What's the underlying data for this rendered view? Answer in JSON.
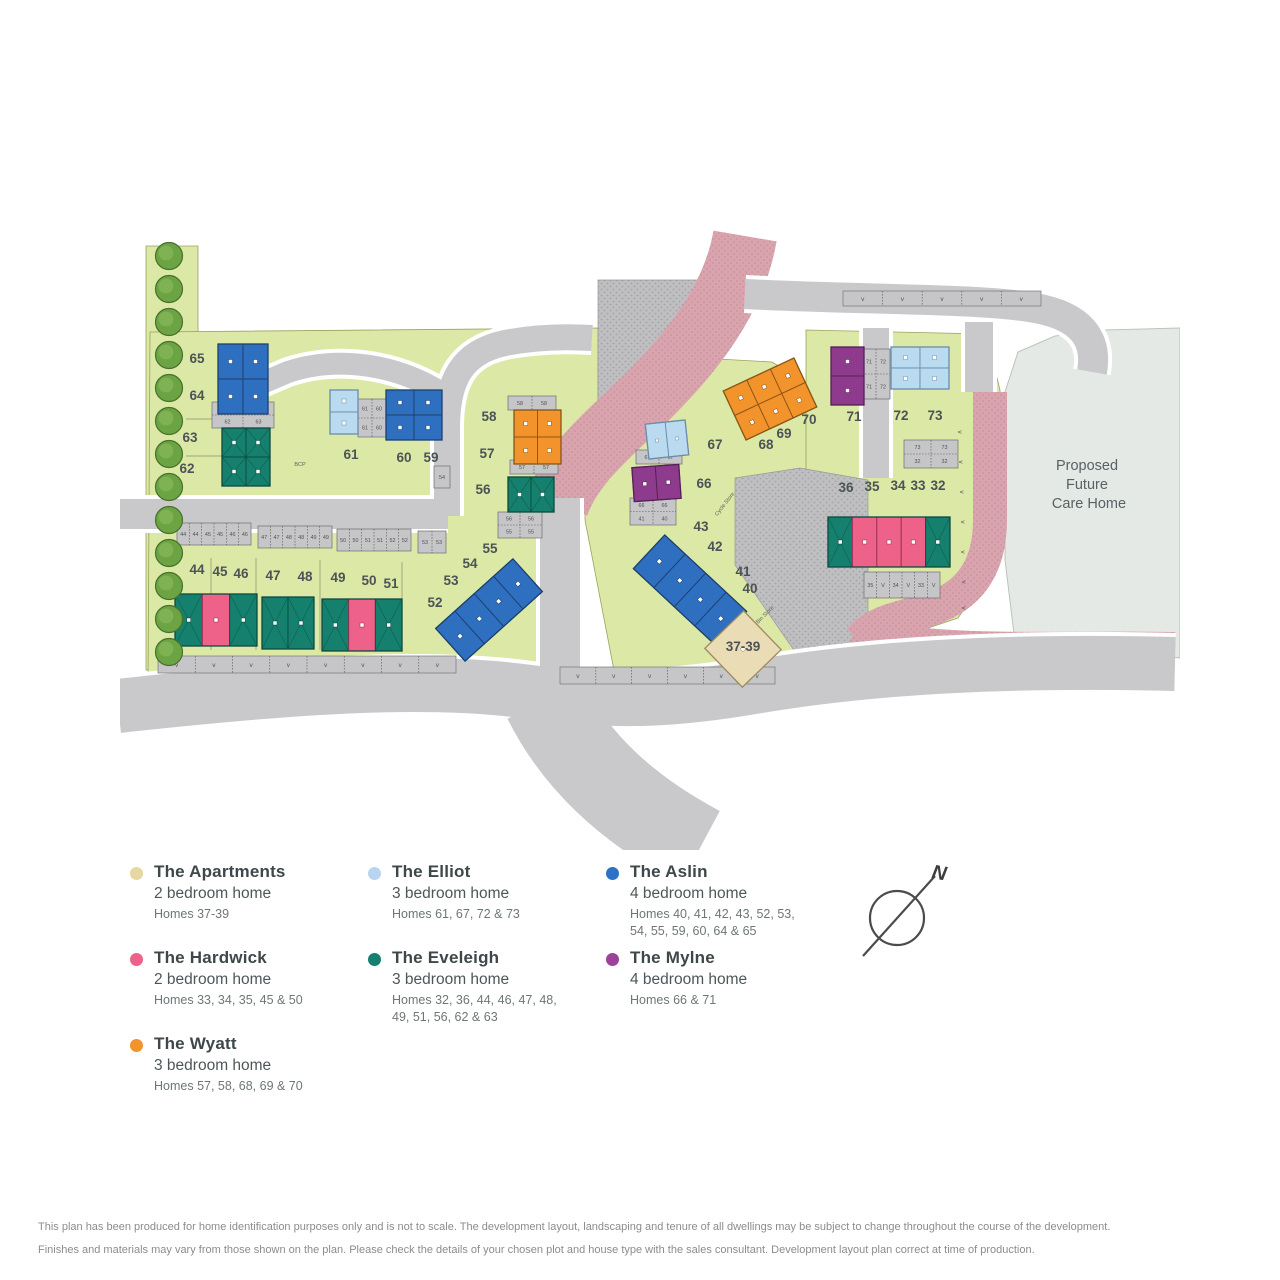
{
  "map": {
    "care_home_label_lines": [
      "Proposed",
      "Future",
      "Care Home"
    ],
    "small_labels": {
      "bcp": "BCP",
      "bin_store": "Bin Store",
      "cycle_store": "Cycle Store",
      "visitor": "v"
    },
    "plot_labels": [
      {
        "t": "65",
        "x": 197,
        "y": 363
      },
      {
        "t": "64",
        "x": 197,
        "y": 400
      },
      {
        "t": "63",
        "x": 190,
        "y": 442
      },
      {
        "t": "62",
        "x": 187,
        "y": 473
      },
      {
        "t": "61",
        "x": 351,
        "y": 459
      },
      {
        "t": "60",
        "x": 404,
        "y": 462
      },
      {
        "t": "59",
        "x": 431,
        "y": 462
      },
      {
        "t": "58",
        "x": 489,
        "y": 421
      },
      {
        "t": "57",
        "x": 487,
        "y": 458
      },
      {
        "t": "56",
        "x": 483,
        "y": 494
      },
      {
        "t": "55",
        "x": 490,
        "y": 553
      },
      {
        "t": "54",
        "x": 470,
        "y": 568
      },
      {
        "t": "53",
        "x": 451,
        "y": 585
      },
      {
        "t": "52",
        "x": 435,
        "y": 607
      },
      {
        "t": "44",
        "x": 197,
        "y": 574
      },
      {
        "t": "45",
        "x": 220,
        "y": 576
      },
      {
        "t": "46",
        "x": 241,
        "y": 578
      },
      {
        "t": "47",
        "x": 273,
        "y": 580
      },
      {
        "t": "48",
        "x": 305,
        "y": 581
      },
      {
        "t": "49",
        "x": 338,
        "y": 582
      },
      {
        "t": "50",
        "x": 369,
        "y": 585
      },
      {
        "t": "51",
        "x": 391,
        "y": 588
      },
      {
        "t": "43",
        "x": 701,
        "y": 531
      },
      {
        "t": "42",
        "x": 715,
        "y": 551
      },
      {
        "t": "41",
        "x": 743,
        "y": 576
      },
      {
        "t": "40",
        "x": 750,
        "y": 593
      },
      {
        "t": "37-39",
        "x": 743,
        "y": 651
      },
      {
        "t": "67",
        "x": 715,
        "y": 449
      },
      {
        "t": "66",
        "x": 704,
        "y": 488
      },
      {
        "t": "68",
        "x": 766,
        "y": 449
      },
      {
        "t": "69",
        "x": 784,
        "y": 438
      },
      {
        "t": "70",
        "x": 809,
        "y": 424
      },
      {
        "t": "71",
        "x": 854,
        "y": 421
      },
      {
        "t": "72",
        "x": 901,
        "y": 420
      },
      {
        "t": "73",
        "x": 935,
        "y": 420
      },
      {
        "t": "36",
        "x": 846,
        "y": 492
      },
      {
        "t": "35",
        "x": 872,
        "y": 491
      },
      {
        "t": "34",
        "x": 898,
        "y": 490
      },
      {
        "t": "33",
        "x": 918,
        "y": 490
      },
      {
        "t": "32",
        "x": 938,
        "y": 490
      }
    ],
    "buildings": [
      {
        "x": 218,
        "y": 344,
        "w": 50,
        "h": 70,
        "rot": 0,
        "rows": 2,
        "cols": 2,
        "c": "aslin"
      },
      {
        "x": 222,
        "y": 428,
        "w": 48,
        "h": 58,
        "rot": 0,
        "rows": 2,
        "cols": 2,
        "c": "eveleigh"
      },
      {
        "x": 330,
        "y": 390,
        "w": 28,
        "h": 44,
        "rot": 0,
        "rows": 2,
        "cols": 1,
        "c": "elliot"
      },
      {
        "x": 386,
        "y": 390,
        "w": 56,
        "h": 50,
        "rot": 0,
        "rows": 2,
        "cols": 2,
        "c": "aslin"
      },
      {
        "x": 514,
        "y": 410,
        "w": 47,
        "h": 54,
        "rot": 0,
        "rows": 2,
        "cols": 2,
        "c": "wyatt"
      },
      {
        "x": 508,
        "y": 477,
        "w": 46,
        "h": 35,
        "rot": 0,
        "rows": 1,
        "cols": 2,
        "c": "eveleigh"
      },
      {
        "x": 437,
        "y": 588,
        "w": 104,
        "h": 44,
        "rot": -42,
        "rows": 1,
        "cols": 4,
        "c": "aslin"
      },
      {
        "x": 175,
        "y": 594,
        "w": 82,
        "h": 52,
        "rot": 0,
        "rows": 1,
        "cols": 3,
        "u": [
          "eveleigh",
          "hardwick",
          "eveleigh"
        ]
      },
      {
        "x": 262,
        "y": 597,
        "w": 52,
        "h": 52,
        "rot": 0,
        "rows": 1,
        "cols": 2,
        "c": "eveleigh"
      },
      {
        "x": 322,
        "y": 599,
        "w": 80,
        "h": 52,
        "rot": 0,
        "rows": 1,
        "cols": 3,
        "u": [
          "eveleigh",
          "hardwick",
          "eveleigh"
        ]
      },
      {
        "x": 634,
        "y": 567,
        "w": 112,
        "h": 46,
        "rot": 43,
        "rows": 1,
        "cols": 4,
        "c": "aslin"
      },
      {
        "x": 716,
        "y": 622,
        "w": 54,
        "h": 54,
        "rot": -44,
        "rows": 1,
        "cols": 1,
        "c": "apartments"
      },
      {
        "x": 647,
        "y": 422,
        "w": 40,
        "h": 35,
        "rot": -6,
        "rows": 1,
        "cols": 2,
        "c": "elliot"
      },
      {
        "x": 633,
        "y": 466,
        "w": 47,
        "h": 34,
        "rot": -4,
        "rows": 1,
        "cols": 2,
        "c": "mylne"
      },
      {
        "x": 731,
        "y": 372,
        "w": 78,
        "h": 54,
        "rot": -25,
        "rows": 2,
        "cols": 3,
        "c": "wyatt"
      },
      {
        "x": 831,
        "y": 347,
        "w": 33,
        "h": 58,
        "rot": 0,
        "rows": 2,
        "cols": 1,
        "c": "mylne"
      },
      {
        "x": 891,
        "y": 347,
        "w": 58,
        "h": 42,
        "rot": 0,
        "rows": 2,
        "cols": 2,
        "c": "elliot"
      },
      {
        "x": 828,
        "y": 517,
        "w": 122,
        "h": 50,
        "rot": 0,
        "rows": 1,
        "cols": 5,
        "u": [
          "eveleigh",
          "hardwick",
          "hardwick",
          "hardwick",
          "eveleigh"
        ]
      }
    ],
    "parking_chips": [
      {
        "x": 177,
        "y": 523,
        "w": 74,
        "h": 22,
        "rows": 1,
        "cols": 6,
        "nums": [
          "44",
          "44",
          "45",
          "45",
          "46",
          "46"
        ]
      },
      {
        "x": 258,
        "y": 526,
        "w": 74,
        "h": 22,
        "rows": 1,
        "cols": 6,
        "nums": [
          "47",
          "47",
          "48",
          "48",
          "49",
          "49"
        ]
      },
      {
        "x": 337,
        "y": 529,
        "w": 74,
        "h": 22,
        "rows": 1,
        "cols": 6,
        "nums": [
          "50",
          "50",
          "51",
          "51",
          "52",
          "52"
        ]
      },
      {
        "x": 418,
        "y": 531,
        "w": 28,
        "h": 22,
        "rows": 1,
        "cols": 2,
        "nums": [
          "53",
          "53"
        ]
      },
      {
        "x": 212,
        "y": 402,
        "w": 62,
        "h": 26,
        "rows": 2,
        "cols": 2,
        "nums": [
          "64",
          "64",
          "62",
          "63"
        ]
      },
      {
        "x": 358,
        "y": 399,
        "w": 28,
        "h": 38,
        "rows": 2,
        "cols": 2,
        "nums": [
          "61",
          "60",
          "61",
          "60"
        ]
      },
      {
        "x": 508,
        "y": 396,
        "w": 48,
        "h": 14,
        "rows": 1,
        "cols": 2,
        "nums": [
          "58",
          "58"
        ]
      },
      {
        "x": 510,
        "y": 460,
        "w": 48,
        "h": 14,
        "rows": 1,
        "cols": 2,
        "nums": [
          "57",
          "57"
        ]
      },
      {
        "x": 498,
        "y": 512,
        "w": 44,
        "h": 26,
        "rows": 2,
        "cols": 2,
        "nums": [
          "56",
          "56",
          "55",
          "55"
        ]
      },
      {
        "x": 434,
        "y": 466,
        "w": 16,
        "h": 22,
        "rows": 1,
        "cols": 1,
        "nums": [
          "54"
        ]
      },
      {
        "x": 636,
        "y": 450,
        "w": 46,
        "h": 14,
        "rows": 1,
        "cols": 2,
        "nums": [
          "67",
          "67"
        ]
      },
      {
        "x": 630,
        "y": 498,
        "w": 46,
        "h": 27,
        "rows": 2,
        "cols": 2,
        "nums": [
          "66",
          "66",
          "41",
          "40"
        ]
      },
      {
        "x": 862,
        "y": 349,
        "w": 28,
        "h": 50,
        "rows": 2,
        "cols": 2,
        "nums": [
          "71",
          "72",
          "71",
          "72"
        ]
      },
      {
        "x": 904,
        "y": 440,
        "w": 54,
        "h": 28,
        "rows": 2,
        "cols": 2,
        "nums": [
          "73",
          "73",
          "32",
          "32"
        ]
      },
      {
        "x": 864,
        "y": 572,
        "w": 76,
        "h": 26,
        "rows": 1,
        "cols": 6,
        "nums": [
          "35",
          "V",
          "34",
          "V",
          "33",
          "V"
        ]
      }
    ],
    "visitor_strips": [
      {
        "x": 158,
        "y": 656,
        "w": 298,
        "h": 17,
        "count": 8
      },
      {
        "x": 560,
        "y": 667,
        "w": 215,
        "h": 17,
        "count": 6
      },
      {
        "x": 843,
        "y": 291,
        "w": 198,
        "h": 15,
        "count": 5
      }
    ],
    "visitor_marks": [
      [
        958,
        432
      ],
      [
        959,
        462
      ],
      [
        960,
        492
      ],
      [
        961,
        522
      ],
      [
        961,
        552
      ],
      [
        962,
        582
      ],
      [
        962,
        608
      ]
    ],
    "trees": {
      "x": 169,
      "y_start": 256,
      "step": 33,
      "count": 13,
      "r": 13.5
    }
  },
  "legend": {
    "items": [
      {
        "name": "The Apartments",
        "type": "2 bedroom home",
        "homes": "Homes 37-39",
        "color": "#e7d7a3"
      },
      {
        "name": "The Elliot",
        "type": "3 bedroom home",
        "homes": "Homes 61, 67, 72 & 73",
        "color": "#b9d4ef"
      },
      {
        "name": "The Aslin",
        "type": "4 bedroom home",
        "homes": "Homes 40, 41, 42, 43, 52, 53,\n54, 55, 59, 60, 64 & 65",
        "color": "#2e72c8"
      },
      {
        "name": "The Hardwick",
        "type": "2 bedroom home",
        "homes": "Homes 33, 34, 35, 45 & 50",
        "color": "#ee6189"
      },
      {
        "name": "The Eveleigh",
        "type": "3 bedroom home",
        "homes": "Homes 32, 36, 44, 46, 47, 48,\n49, 51, 56, 62 & 63",
        "color": "#15806d"
      },
      {
        "name": "The Mylne",
        "type": "4 bedroom home",
        "homes": "Homes 66 & 71",
        "color": "#9c4398"
      },
      {
        "name": "The Wyatt",
        "type": "3 bedroom home",
        "homes": "Homes 57, 58, 68, 69 & 70",
        "color": "#f2932b"
      }
    ]
  },
  "compass": {
    "north_label": "N"
  },
  "disclaimer": {
    "line1": "This plan has been produced for home identification purposes only and is not to scale. The development layout, landscaping and tenure of all dwellings may be subject to change throughout the course of the development.",
    "line2": "Finishes and materials may vary from those shown on the plan. Please check the details of your chosen plot and house type with the sales consultant. Development layout plan correct at time of production."
  },
  "colors": {
    "parcel_green": "#dce8a6",
    "road_grey": "#c9c9cb",
    "paving_grey": "#bfbfc1",
    "footpath_pink": "#d9a4ae",
    "care_home_area": "#e4e9e5",
    "tree_green": "#6ca343",
    "house_types": {
      "aslin": {
        "f": "#2e6fc0",
        "s": "#1d3f6e"
      },
      "elliot": {
        "f": "#badaf0",
        "s": "#6b8cab"
      },
      "eveleigh": {
        "f": "#15806d",
        "s": "#0a4a3e"
      },
      "wyatt": {
        "f": "#f2932b",
        "s": "#8a5515"
      },
      "hardwick": {
        "f": "#ee6189",
        "s": "#97304f"
      },
      "mylne": {
        "f": "#8e3b8e",
        "s": "#542055"
      },
      "apartments": {
        "f": "#eaddb6",
        "s": "#9c8d62"
      }
    }
  }
}
